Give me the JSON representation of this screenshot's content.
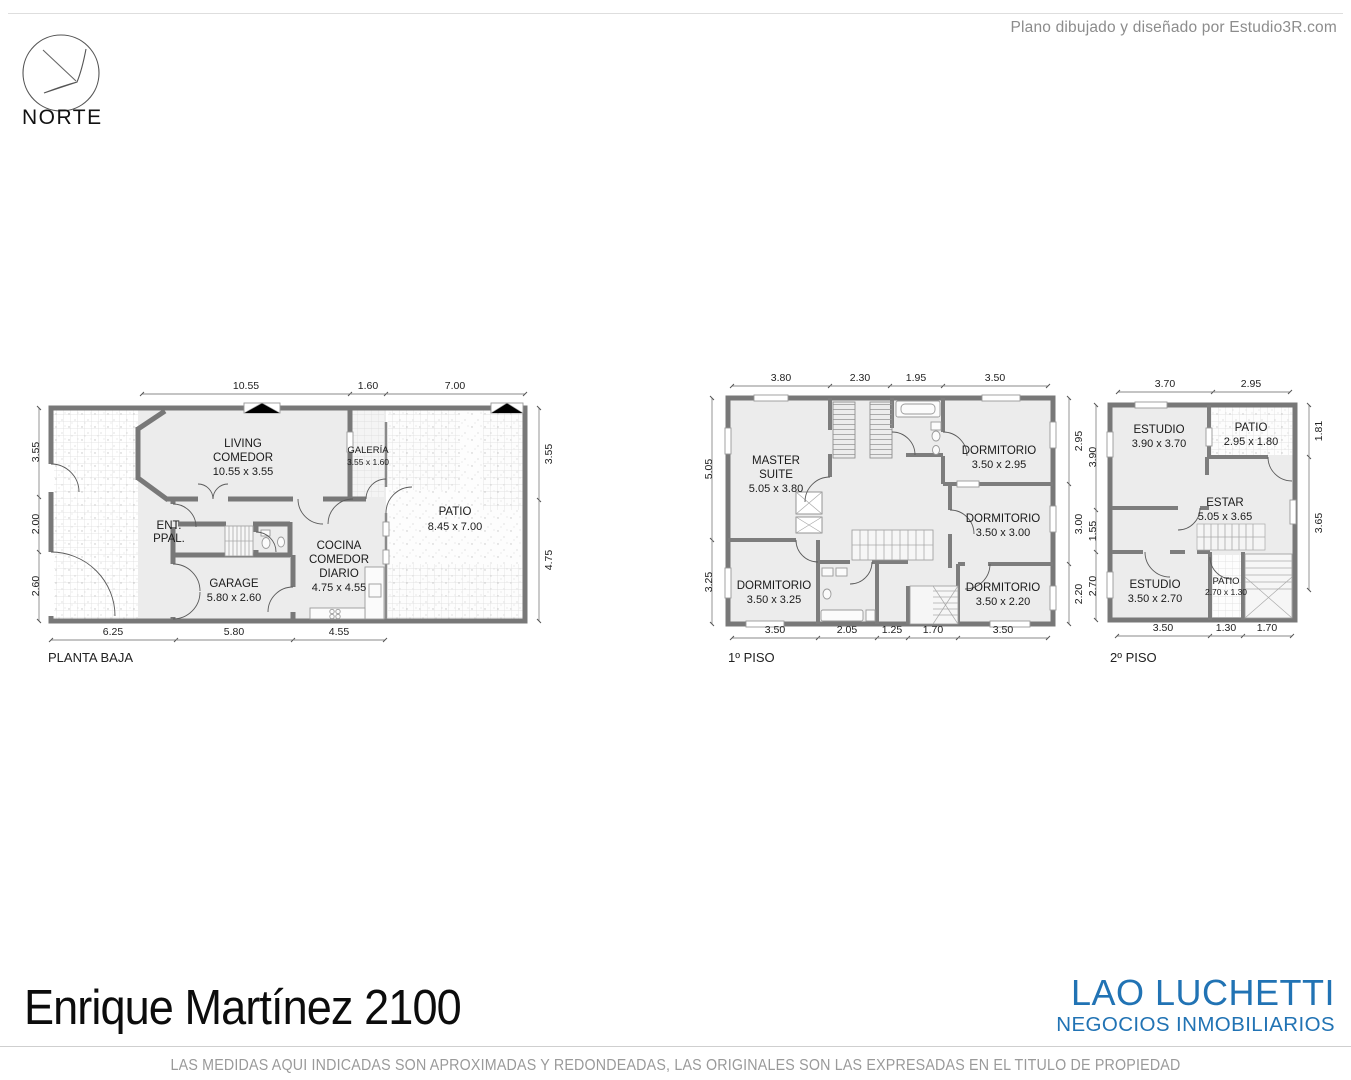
{
  "page": {
    "credit": "Plano dibujado y diseñado por Estudio3R.com",
    "compass_label": "NORTE",
    "title": "Enrique Martínez 2100",
    "brand": "LAO LUCHETTI",
    "brand_sub": "NEGOCIOS INMOBILIARIOS",
    "disclaimer": "LAS MEDIDAS AQUI INDICADAS SON APROXIMADAS Y REDONDEADAS, LAS ORIGINALES SON LAS EXPRESADAS EN EL TITULO DE PROPIEDAD"
  },
  "colors": {
    "brand_blue": "#2173b4",
    "wall_gray": "#787878",
    "floor_gray": "#ececec",
    "text_gray": "#8c8c8c"
  },
  "plans": [
    {
      "label": "PLANTA BAJA",
      "rooms": [
        {
          "l1": "LIVING",
          "l2": "COMEDOR",
          "size": "10.55 x 3.55"
        },
        {
          "l1": "GALERÍA",
          "size": "3.55 x 1.60"
        },
        {
          "l1": "PATIO",
          "size": "8.45 x 7.00"
        },
        {
          "l1": "ENT.",
          "l2": "PPAL."
        },
        {
          "l1": "COCINA",
          "l2": "COMEDOR",
          "l3": "DIARIO",
          "size": "4.75 x 4.55"
        },
        {
          "l1": "GARAGE",
          "size": "5.80 x 2.60"
        }
      ],
      "dims_top": [
        "10.55",
        "1.60",
        "7.00"
      ],
      "dims_bottom": [
        "6.25",
        "5.80",
        "4.55"
      ],
      "dims_left": [
        "3.55",
        "2.00",
        "2.60"
      ],
      "dims_right": [
        "3.55",
        "4.75"
      ]
    },
    {
      "label": "1º PISO",
      "rooms": [
        {
          "l1": "MASTER",
          "l2": "SUITE",
          "size": "5.05 x 3.80"
        },
        {
          "l1": "DORMITORIO",
          "size": "3.50 x 2.95"
        },
        {
          "l1": "DORMITORIO",
          "size": "3.50 x 3.00"
        },
        {
          "l1": "DORMITORIO",
          "size": "3.50 x 2.20"
        },
        {
          "l1": "DORMITORIO",
          "size": "3.50 x 3.25"
        }
      ],
      "dims_top": [
        "3.80",
        "2.30",
        "1.95",
        "3.50"
      ],
      "dims_bottom": [
        "3.50",
        "2.05",
        "1.25",
        "1.70",
        "3.50"
      ],
      "dims_left": [
        "5.05",
        "3.25"
      ],
      "dims_right": [
        "2.95",
        "3.00",
        "2.20"
      ]
    },
    {
      "label": "2º PISO",
      "rooms": [
        {
          "l1": "ESTUDIO",
          "size": "3.90 x 3.70"
        },
        {
          "l1": "PATIO",
          "size": "2.95 x 1.80"
        },
        {
          "l1": "ESTAR",
          "size": "5.05 x 3.65"
        },
        {
          "l1": "ESTUDIO",
          "size": "3.50 x 2.70"
        },
        {
          "l1": "PATIO",
          "size": "2.70 x 1.30"
        }
      ],
      "dims_top": [
        "3.70",
        "2.95"
      ],
      "dims_bottom": [
        "3.50",
        "1.30",
        "1.70"
      ],
      "dims_left": [
        "3.90",
        "1.55",
        "2.70"
      ],
      "dims_right": [
        "1.81",
        "3.65"
      ]
    }
  ]
}
